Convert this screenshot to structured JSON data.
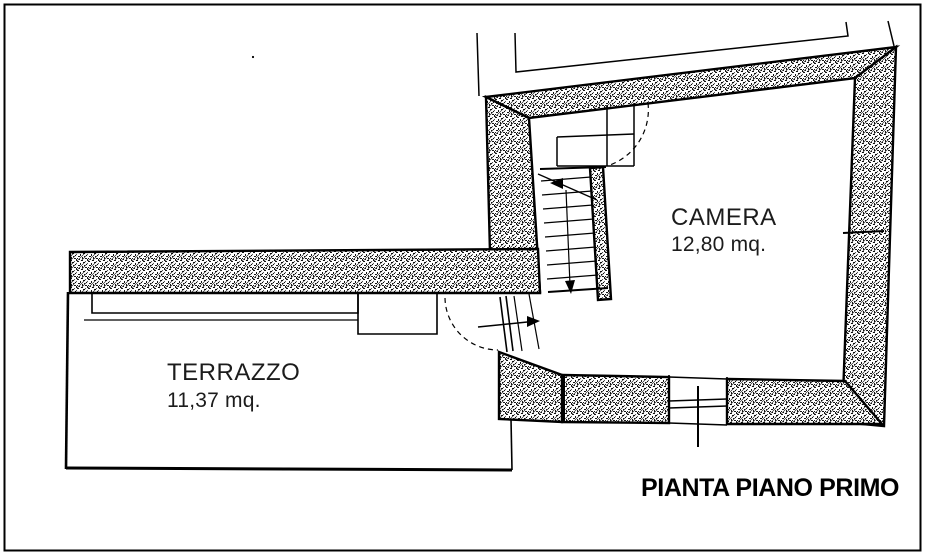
{
  "plan": {
    "caption": "PIANTA PIANO PRIMO",
    "rooms": [
      {
        "id": "camera",
        "name": "CAMERA",
        "area": "12,80 mq."
      },
      {
        "id": "terrazzo",
        "name": "TERRAZZO",
        "area": "11,37 mq."
      }
    ]
  },
  "colors": {
    "ink": "#000000",
    "paper": "#ffffff"
  }
}
